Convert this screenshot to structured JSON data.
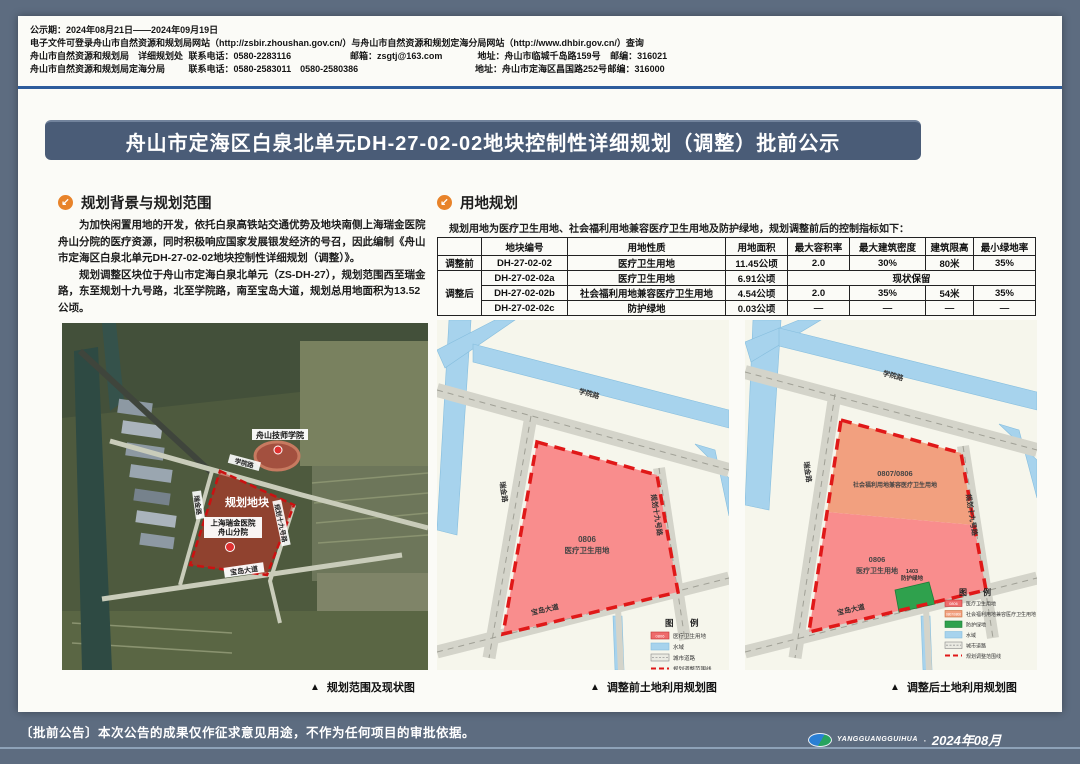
{
  "header": {
    "notice_period": "公示期：2024年08月21日——2024年09月19日",
    "website_line": "电子文件可登录舟山市自然资源和规划局网站（http://zsbir.zhoushan.gov.cn/）与舟山市自然资源和规划定海分局网站（http://www.dhbir.gov.cn/）查询",
    "dept1": {
      "org": "舟山市自然资源和规划局　详细规划处",
      "tel": "联系电话：0580-2283116",
      "mail": "邮箱：zsgtj@163.com",
      "addr": "地址：舟山市临城千岛路159号",
      "zip": "邮编：316021"
    },
    "dept2": {
      "org": "舟山市自然资源和规划局定海分局",
      "tel": "联系电话：0580-2583011　0580-2580386",
      "addr": "地址：舟山市定海区昌国路252号",
      "zip": "邮编：316000"
    }
  },
  "title": "舟山市定海区白泉北单元DH-27-02-02地块控制性详细规划（调整）批前公示",
  "section_background": {
    "icon": "↙",
    "title": "规划背景与规划范围",
    "para1": "为加快闲置用地的开发，依托白泉高铁站交通优势及地块南侧上海瑞金医院舟山分院的医疗资源，同时积极响应国家发展银发经济的号召，因此编制《舟山市定海区白泉北单元DH-27-02-02地块控制性详细规划（调整）》。",
    "para2": "规划调整区块位于舟山市定海白泉北单元（ZS-DH-27），规划范围西至瑞金路，东至规划十九号路，北至学院路，南至宝岛大道，规划总用地面积为13.52 公顷。"
  },
  "section_landuse": {
    "icon": "↙",
    "title": "用地规划",
    "intro": "规划用地为医疗卫生用地、社会福利用地兼容医疗卫生用地及防护绿地，规划调整前后的控制指标如下："
  },
  "table": {
    "headers": [
      "地块编号",
      "用地性质",
      "用地面积",
      "最大容积率",
      "最大建筑密度",
      "建筑限高",
      "最小绿地率"
    ],
    "group_before": "调整前",
    "group_after": "调整后",
    "rows": [
      {
        "code": "DH-27-02-02",
        "use": "医疗卫生用地",
        "area": "11.45公顷",
        "far": "2.0",
        "density": "30%",
        "height": "80米",
        "green": "35%"
      },
      {
        "code": "DH-27-02-02a",
        "use": "医疗卫生用地",
        "area": "6.91公顷",
        "merged": "现状保留"
      },
      {
        "code": "DH-27-02-02b",
        "use": "社会福利用地兼容医疗卫生用地",
        "area": "4.54公顷",
        "far": "2.0",
        "density": "35%",
        "height": "54米",
        "green": "35%"
      },
      {
        "code": "DH-27-02-02c",
        "use": "防护绿地",
        "area": "0.03公顷",
        "far": "—",
        "density": "—",
        "height": "—",
        "green": "—"
      }
    ]
  },
  "satellite": {
    "marker": "▲",
    "caption": "规划范围及现状图",
    "labels": {
      "school": "舟山技师学院",
      "parcel": "规划地块",
      "hospital_line1": "上海瑞金医院",
      "hospital_line2": "舟山分院",
      "road_top": "学院路",
      "road_left": "瑞金路",
      "road_right": "规划十九号路",
      "road_bottom": "宝岛大道"
    }
  },
  "map_before": {
    "marker": "▲",
    "caption": "调整前土地利用规划图",
    "roads": {
      "top": "学院路",
      "left": "瑞金路",
      "right": "规划十九号路",
      "bottom": "宝岛大道"
    },
    "parcel": {
      "code": "0806",
      "use": "医疗卫生用地"
    },
    "legend": {
      "title": "图　例",
      "items": [
        {
          "code": "0806",
          "label": "医疗卫生用地"
        },
        {
          "label": "水域"
        },
        {
          "label": "城市道路"
        },
        {
          "label": "规划调整范围线"
        }
      ]
    }
  },
  "map_after": {
    "marker": "▲",
    "caption": "调整后土地利用规划图",
    "roads": {
      "top": "学院路",
      "left": "瑞金路",
      "right": "规划十九号路",
      "bottom": "宝岛大道"
    },
    "parcel_welfare": {
      "code": "0807/0806",
      "use": "社会福利用地兼容医疗卫生用地"
    },
    "parcel_medical": {
      "code": "0806",
      "use": "医疗卫生用地"
    },
    "parcel_green": {
      "code": "1403",
      "use": "防护绿地"
    },
    "legend": {
      "title": "图　例",
      "items": [
        {
          "code": "0806",
          "label": "医疗卫生用地"
        },
        {
          "code": "0807/0806",
          "label": "社会福利用地兼容医疗卫生用地"
        },
        {
          "label": "防护绿地"
        },
        {
          "label": "水域"
        },
        {
          "label": "城市道路"
        },
        {
          "label": "规划调整范围线"
        }
      ]
    }
  },
  "footer": {
    "notice": "〔批前公告〕本次公告的成果仅作征求意见用途，不作为任何项目的审批依据。",
    "brand": "YANGGUANGGUIHUA",
    "separator": "·",
    "date": "2024年08月"
  },
  "colors": {
    "background": "#5d6c80",
    "banner": "#4a5c77",
    "section_icon": "#e8832a",
    "rule_blue": "#2d5c9c",
    "parcel_medical": "#f98d8d",
    "parcel_welfare": "#f2a07f",
    "parcel_green": "#2fa14d",
    "water": "#a7d3ed",
    "boundary_red": "#dd1717"
  }
}
